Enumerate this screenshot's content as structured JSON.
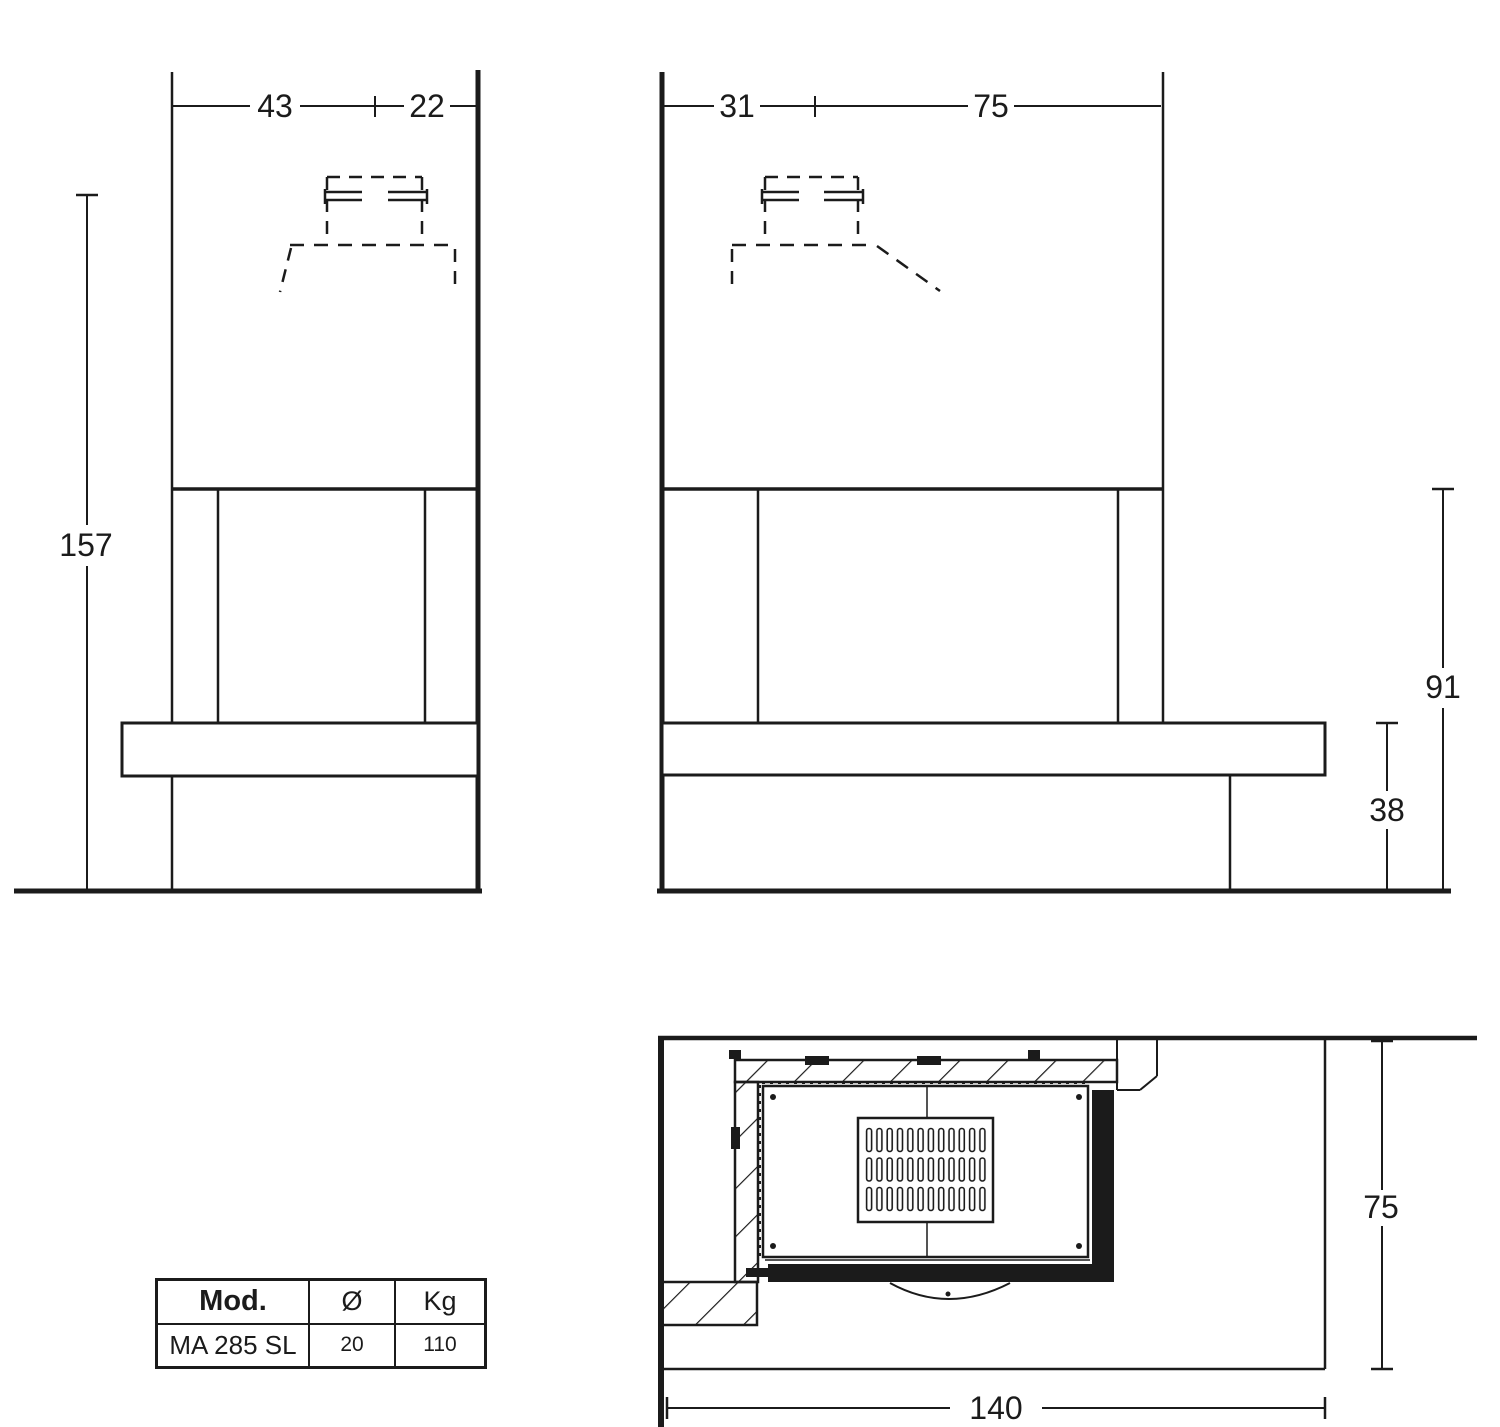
{
  "colors": {
    "ink": "#1b1b1b",
    "background": "#ffffff"
  },
  "front_view": {
    "label_width_left": "43",
    "label_width_right": "22",
    "label_total_height": "157"
  },
  "side_view": {
    "label_depth_left": "31",
    "label_depth_right": "75",
    "label_hearth_height": "91",
    "label_base_height": "38"
  },
  "plan_view": {
    "label_depth": "75",
    "label_width": "140"
  },
  "spec_table": {
    "headers": [
      "Mod.",
      "Ø",
      "Kg"
    ],
    "row": [
      "MA 285 SL",
      "20",
      "110"
    ]
  }
}
